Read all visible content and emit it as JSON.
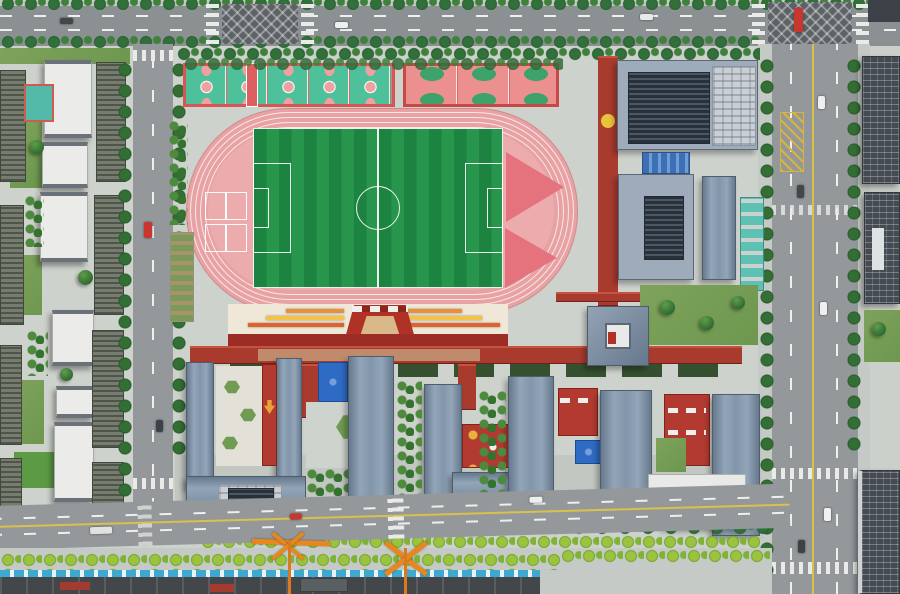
{
  "scene": {
    "type": "aerial-photograph",
    "view": "top-down drone view, daytime, sunny",
    "subject": "New school campus with running track, soccer field and basketball courts, flanked by residential blocks, office towers, city roads and a construction zone"
  },
  "features": {
    "running_track": "8-lane pink running track",
    "soccer_field": "Striped green soccer field with white markings",
    "basketball_courts_green": "Row of green basketball courts with pink keys",
    "basketball_courts_red": "Row of red courts with green keys",
    "grandstand": "Stepped plaza with orange and yellow sunburst stripes",
    "red_corridor": "Elevated dark-red connecting corridor",
    "school_buildings": "School buildings with blue-grey roofs and rooftop solar panels",
    "pyramid_building": "Square pavilion with grey hip roof and central skylight",
    "residential_blocks": "Residential buildings with white flat roofs and dark facades",
    "office_buildings": "Office towers with dark gridded facades",
    "top_road": "East-west avenue with tree median and hatched intersections",
    "left_road": "North-south street west of campus",
    "right_road": "Wide north-south avenue east of campus",
    "bottom_road": "South avenue with street trees",
    "construction_zone": "Riverside construction strip with blue fencing and orange masts",
    "blue_playground": "Blue soft-surface play area",
    "garden_plots": "Student garden allotment beds"
  },
  "palette": {
    "track_pink": "#e8a2a4",
    "field_green_dark": "#1c8440",
    "field_green_light": "#27954b",
    "court_green": "#4ec09a",
    "court_red": "#ec8f8f",
    "roof_blue_grey": "#8296ab",
    "solar_dark": "#343d48",
    "corridor_red": "#a83a2e",
    "plaza_cream": "#efe8d9",
    "stripe_orange": "#e8903a",
    "stripe_yellow": "#f3c24a",
    "asphalt": "#94989b",
    "tree_green": "#2e6b31",
    "tree_bright": "#9cc33e",
    "playground_blue": "#2e6bc4",
    "fence_blue": "#3fa8d0",
    "crane_orange": "#e8871e",
    "white_roof": "#ebecea"
  },
  "counts": {
    "green_courts": 5,
    "red_courts": 3,
    "track_lanes": 8
  }
}
